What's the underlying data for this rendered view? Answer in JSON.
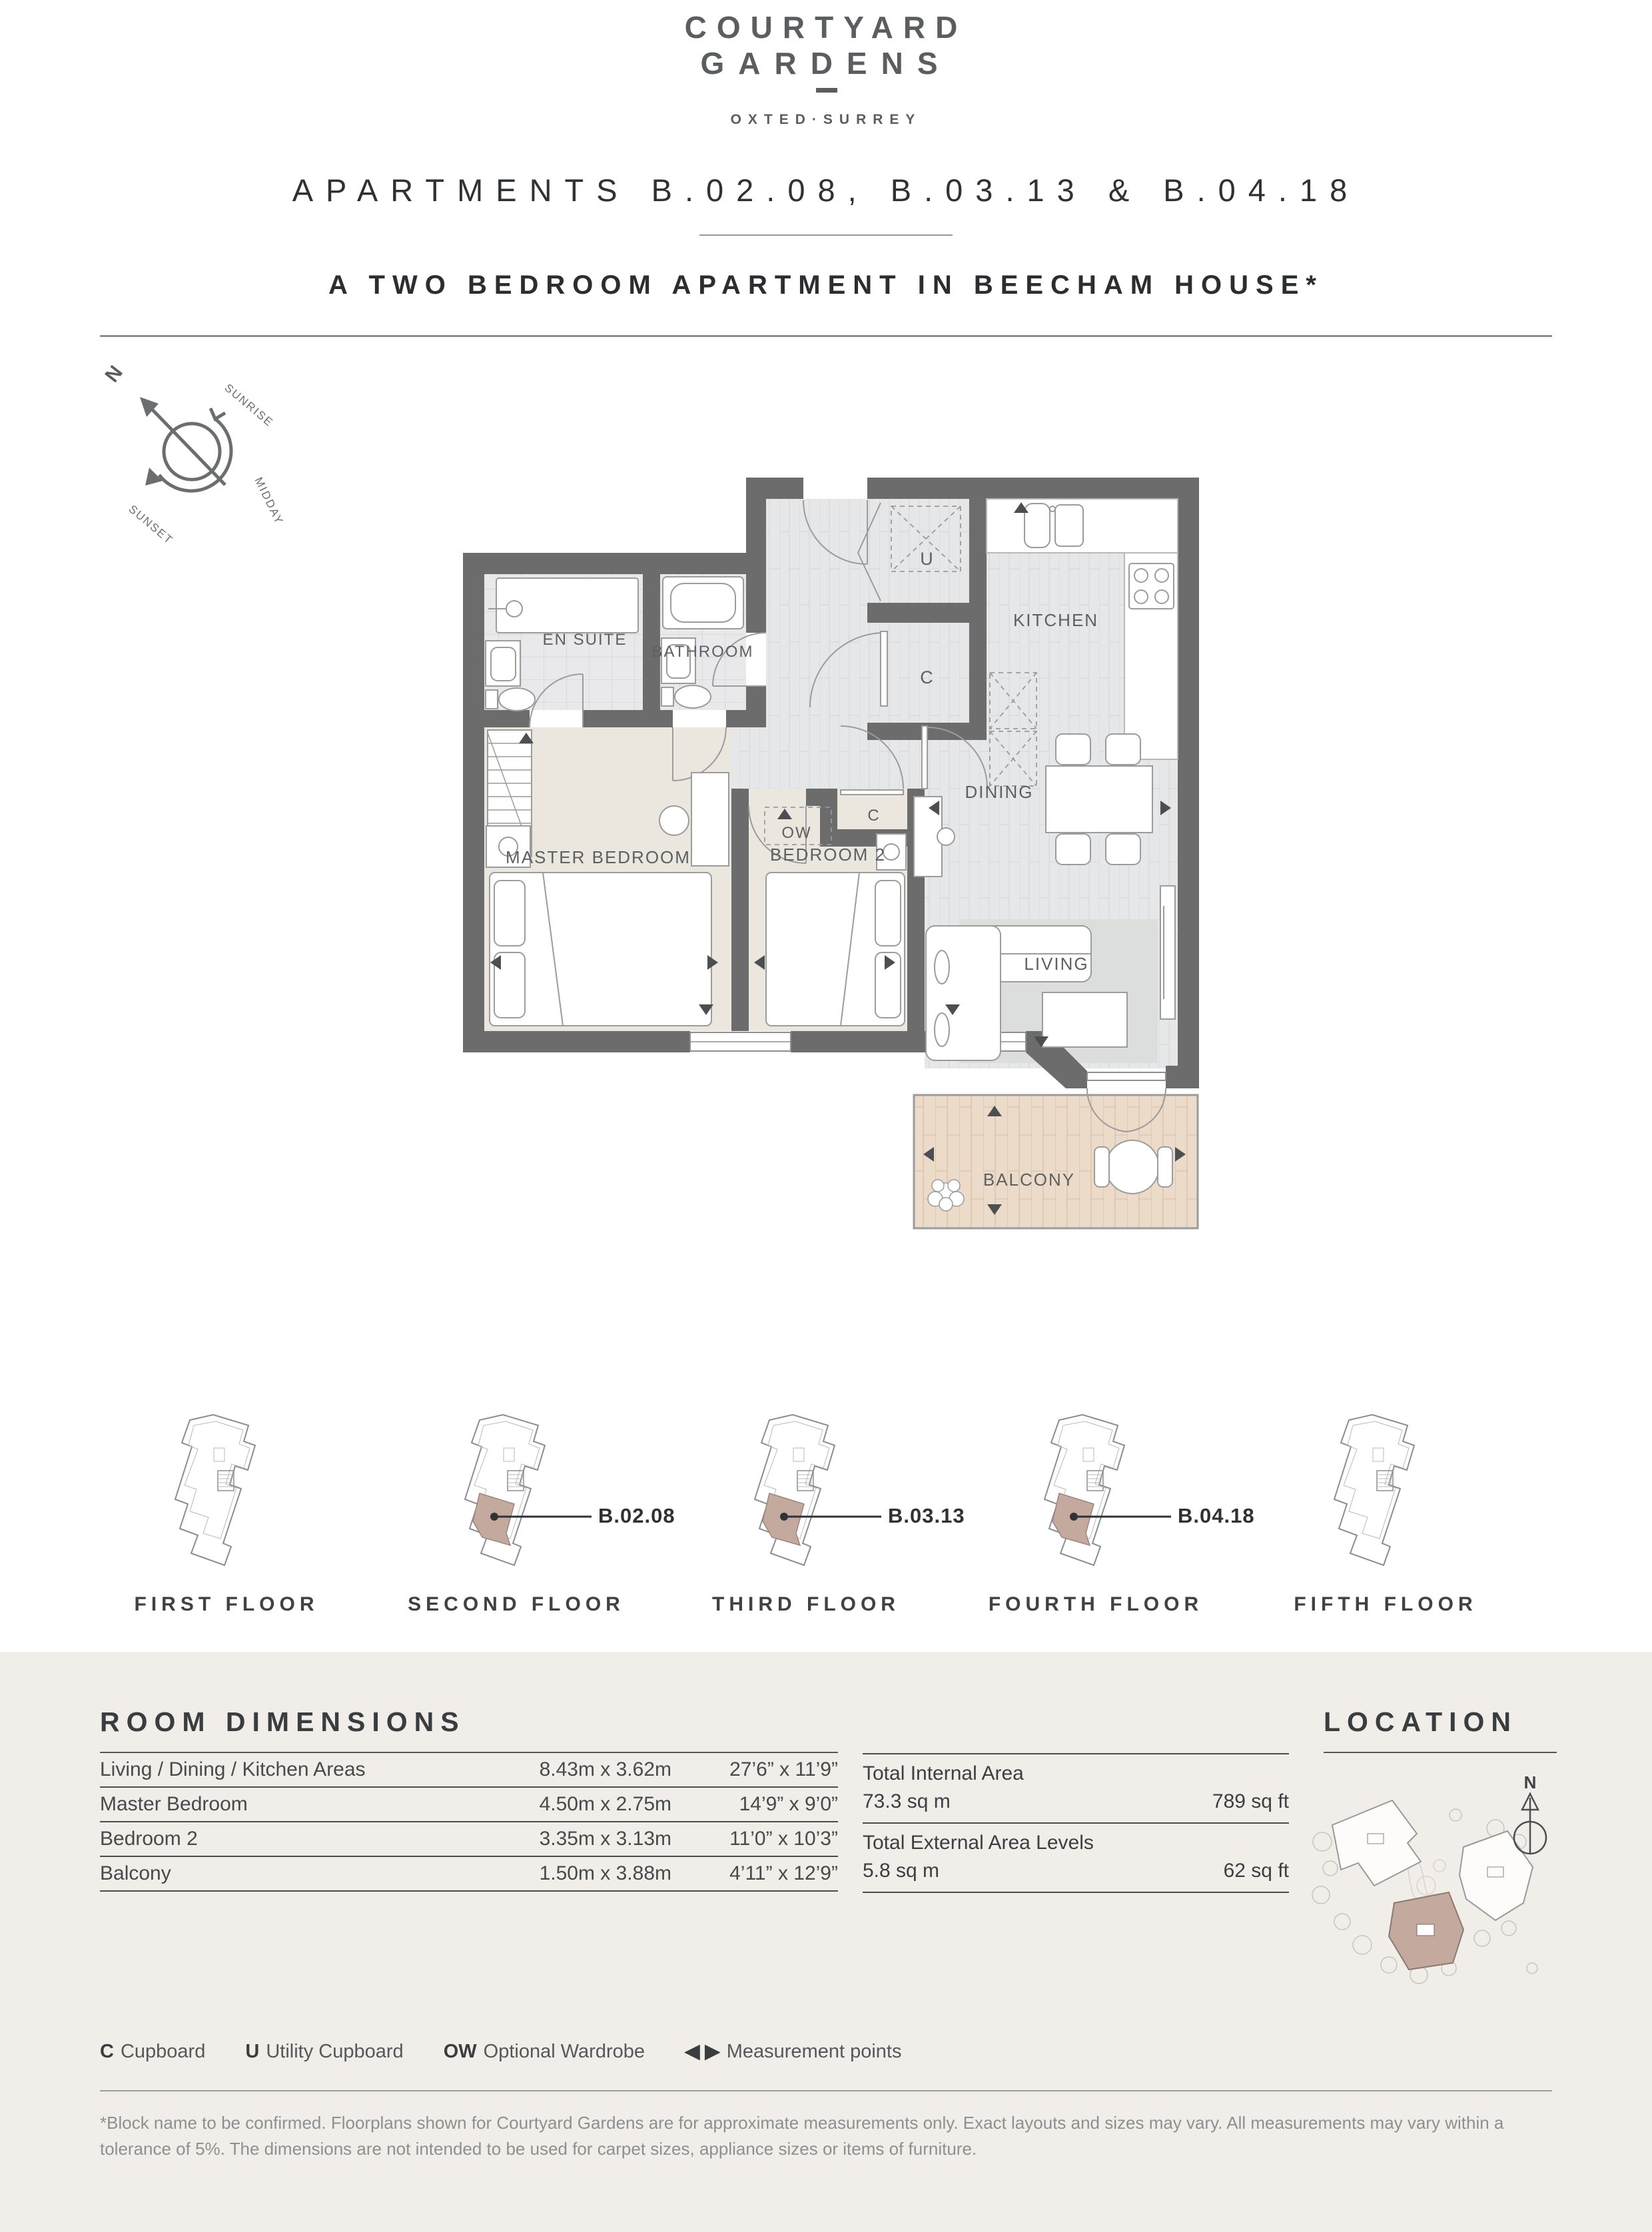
{
  "brand": {
    "name_line1": "COURTYARD",
    "name_line2": "GARDENS",
    "location": "OXTED·SURREY"
  },
  "header": {
    "title": "APARTMENTS  B.02.08, B.03.13 & B.04.18",
    "subtitle": "A TWO BEDROOM APARTMENT IN BEECHAM HOUSE*"
  },
  "compass": {
    "north": "N",
    "sunrise": "SUNRISE",
    "midday": "MIDDAY",
    "sunset": "SUNSET"
  },
  "floor_plan": {
    "rooms": {
      "en_suite": "EN SUITE",
      "bathroom": "BATHROOM",
      "utility": "U",
      "cupboard_kitchen": "C",
      "kitchen": "KITCHEN",
      "dining": "DINING",
      "cupboard_hall": "C",
      "optional_wardrobe": "OW",
      "master_bedroom": "MASTER BEDROOM",
      "bedroom_2": "BEDROOM 2",
      "living": "LIVING",
      "balcony": "BALCONY"
    }
  },
  "floor_key": {
    "floors": [
      {
        "label": "FIRST FLOOR",
        "apartment": ""
      },
      {
        "label": "SECOND FLOOR",
        "apartment": "B.02.08"
      },
      {
        "label": "THIRD FLOOR",
        "apartment": "B.03.13"
      },
      {
        "label": "FOURTH FLOOR",
        "apartment": "B.04.18"
      },
      {
        "label": "FIFTH FLOOR",
        "apartment": ""
      }
    ]
  },
  "room_dimensions": {
    "heading": "ROOM DIMENSIONS",
    "rows": [
      {
        "name": "Living / Dining / Kitchen Areas",
        "metric": "8.43m x 3.62m",
        "imperial": "27’6” x 11’9”"
      },
      {
        "name": "Master Bedroom",
        "metric": "4.50m x 2.75m",
        "imperial": "14’9” x 9’0”"
      },
      {
        "name": "Bedroom 2",
        "metric": "3.35m x 3.13m",
        "imperial": "11’0” x 10’3”"
      },
      {
        "name": "Balcony",
        "metric": "1.50m x 3.88m",
        "imperial": "4’11” x 12’9”"
      }
    ]
  },
  "totals": {
    "internal_label": "Total Internal Area",
    "internal_metric": "73.3 sq m",
    "internal_imperial": "789 sq ft",
    "external_label": "Total External Area Levels",
    "external_metric": "5.8 sq m",
    "external_imperial": "62 sq ft"
  },
  "location": {
    "heading": "LOCATION",
    "north": "N"
  },
  "legend": {
    "items": [
      {
        "key": "C",
        "label": "Cupboard"
      },
      {
        "key": "U",
        "label": "Utility Cupboard"
      },
      {
        "key": "OW",
        "label": "Optional Wardrobe"
      },
      {
        "key": "◀ ▶",
        "label": "Measurement points"
      }
    ]
  },
  "disclaimer": "*Block name to be confirmed. Floorplans shown for Courtyard Gardens are for approximate measurements only. Exact layouts and sizes may vary. All measurements may vary within a tolerance of 5%. The dimensions are not intended to be used for carpet sizes, appliance sizes or items of furniture.",
  "colors": {
    "accent_highlight": "#c3a99e",
    "wall": "#6c6c6c",
    "panel_bg": "#f1ede9",
    "text_dark": "#3a3d40",
    "text_light": "#8d9092"
  }
}
